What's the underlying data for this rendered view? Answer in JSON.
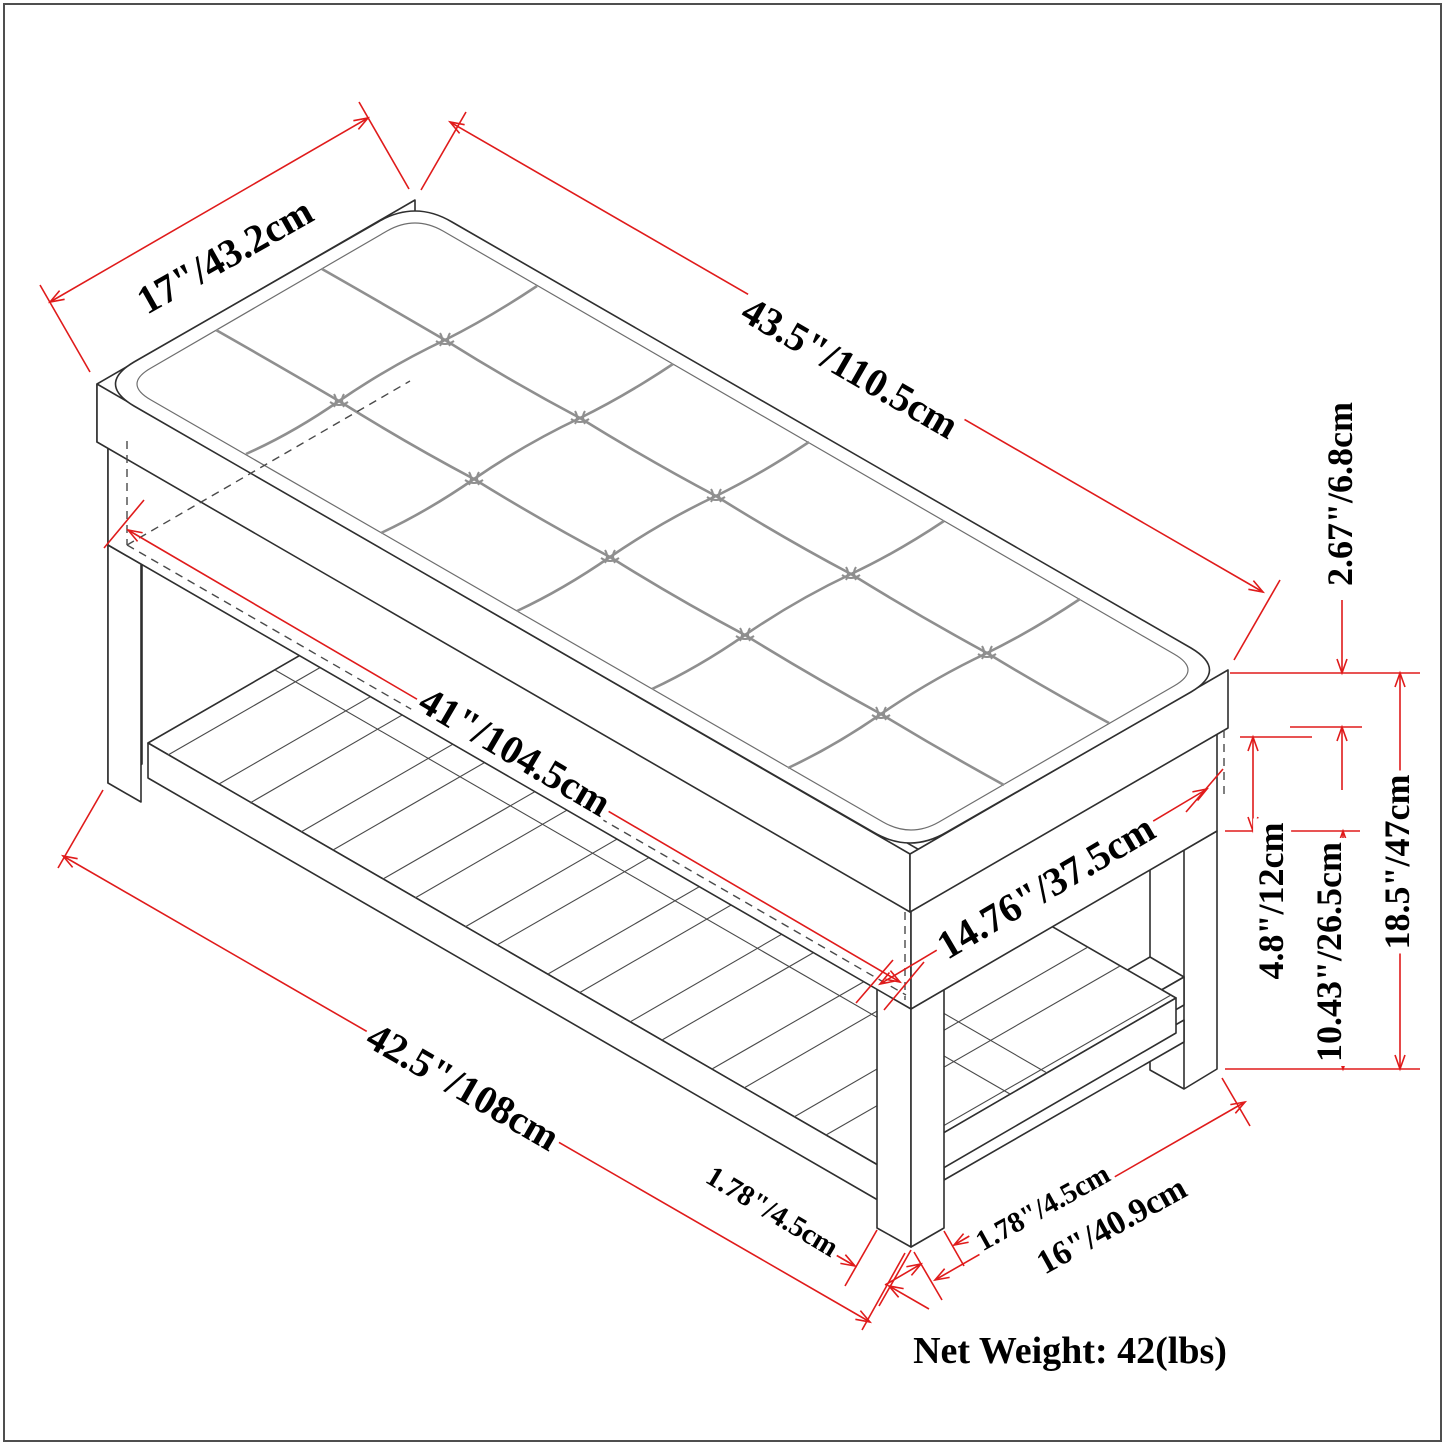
{
  "page": {
    "background": "#ffffff",
    "border_color": "#4f4f4f"
  },
  "colors": {
    "dimension_red": "#e01b1b",
    "line_black": "#2f2f2f",
    "seam_gray": "#8f8f8f"
  },
  "diagram": {
    "type": "isometric-furniture-dimension-drawing",
    "subject": "tufted bench with lower slatted shoe shelf",
    "dimensions": {
      "seat_depth": "17\"/43.2cm",
      "seat_length": "43.5\"/110.5cm",
      "cushion_thickness": "2.67\"/6.8cm",
      "inner_length": "41\"/104.5cm",
      "inner_depth": "14.76\"/37.5cm",
      "frame_height": "4.8\"/12cm",
      "clearance_height": "10.43\"/26.5cm",
      "total_height": "18.5\"/47cm",
      "base_length": "42.5\"/108cm",
      "leg_width_front": "1.78\"/4.5cm",
      "leg_width_side": "1.78\"/4.5cm",
      "end_width": "16\"/40.9cm"
    },
    "net_weight": "Net Weight: 42(lbs)"
  }
}
